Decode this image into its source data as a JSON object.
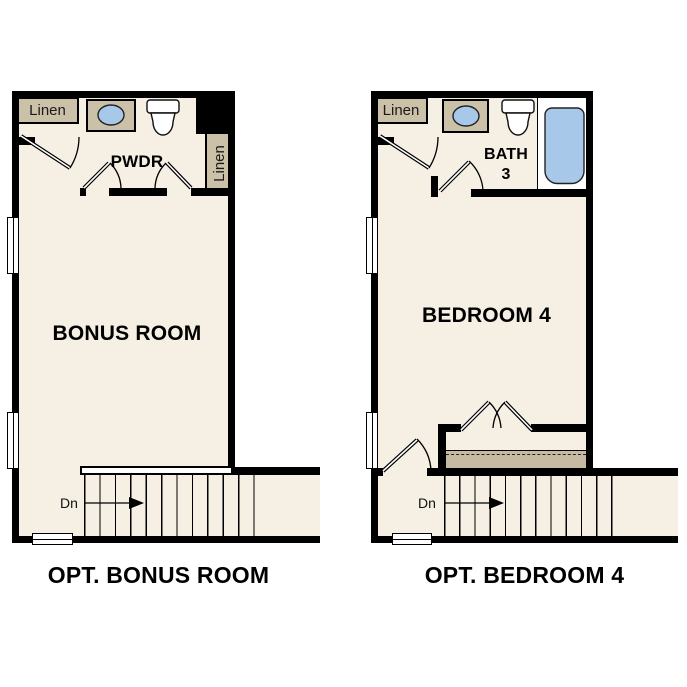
{
  "colors": {
    "background": "#ffffff",
    "wall": "#000000",
    "floor": "#f5efe4",
    "cabinet_tan": "#cbc0a8",
    "closet_shelf_tan": "#c6bba2",
    "fixture_blue": "#a7c8e8",
    "text": "#000000"
  },
  "plans": [
    {
      "caption": "OPT. BONUS ROOM",
      "room_label": "BONUS ROOM",
      "powder_label": "PWDR",
      "linen_top_label": "Linen",
      "linen_side_label": "Linen",
      "stairs_label": "Dn"
    },
    {
      "caption": "OPT. BEDROOM 4",
      "room_label": "BEDROOM 4",
      "bath_label_line1": "BATH",
      "bath_label_line2": "3",
      "linen_top_label": "Linen",
      "stairs_label": "Dn"
    }
  ]
}
